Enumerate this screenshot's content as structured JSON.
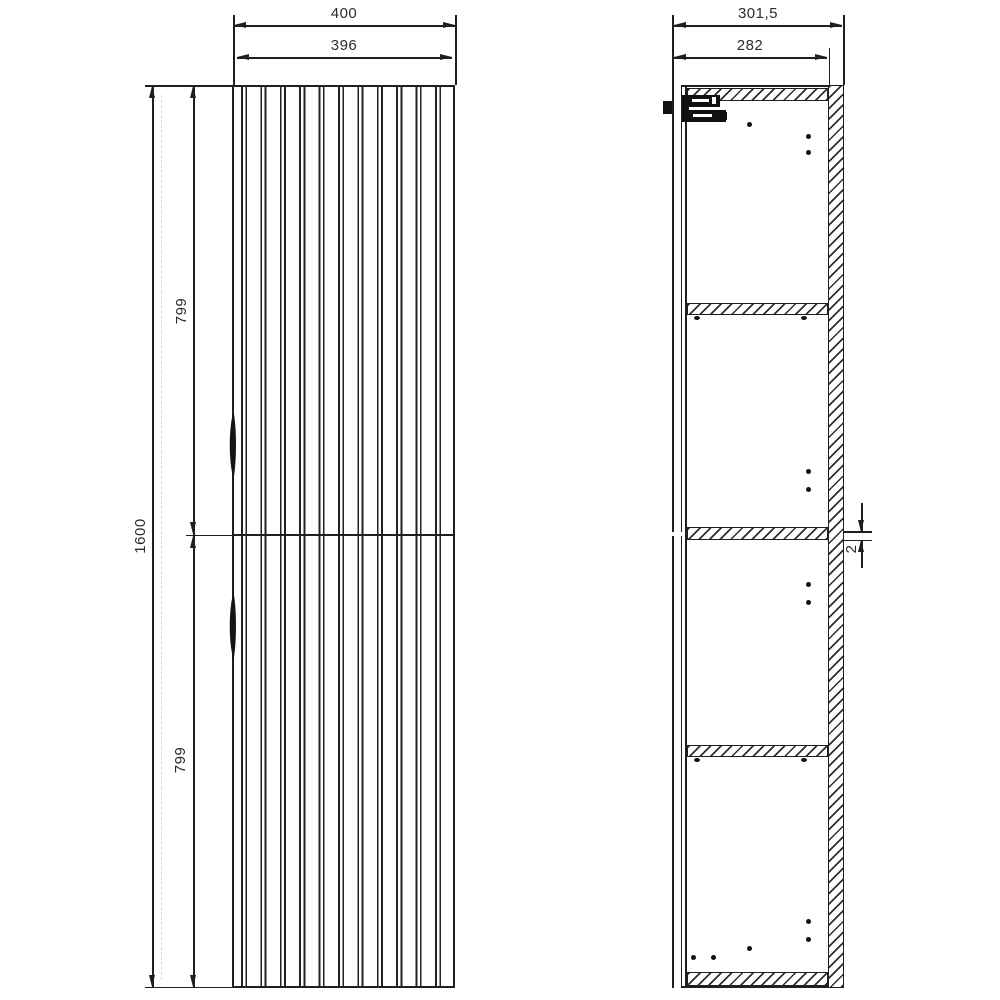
{
  "drawing_title": "tall cabinet technical drawing - front and side section views",
  "front_view": {
    "width_outer": "400",
    "width_inner": "396",
    "height_total": "1600",
    "door_upper_height": "799",
    "door_lower_height": "799"
  },
  "side_view": {
    "depth_outer": "301,5",
    "depth_inner": "282",
    "door_gap": "2"
  },
  "colors": {
    "line": "#1f1f1f",
    "background": "#ffffff"
  }
}
